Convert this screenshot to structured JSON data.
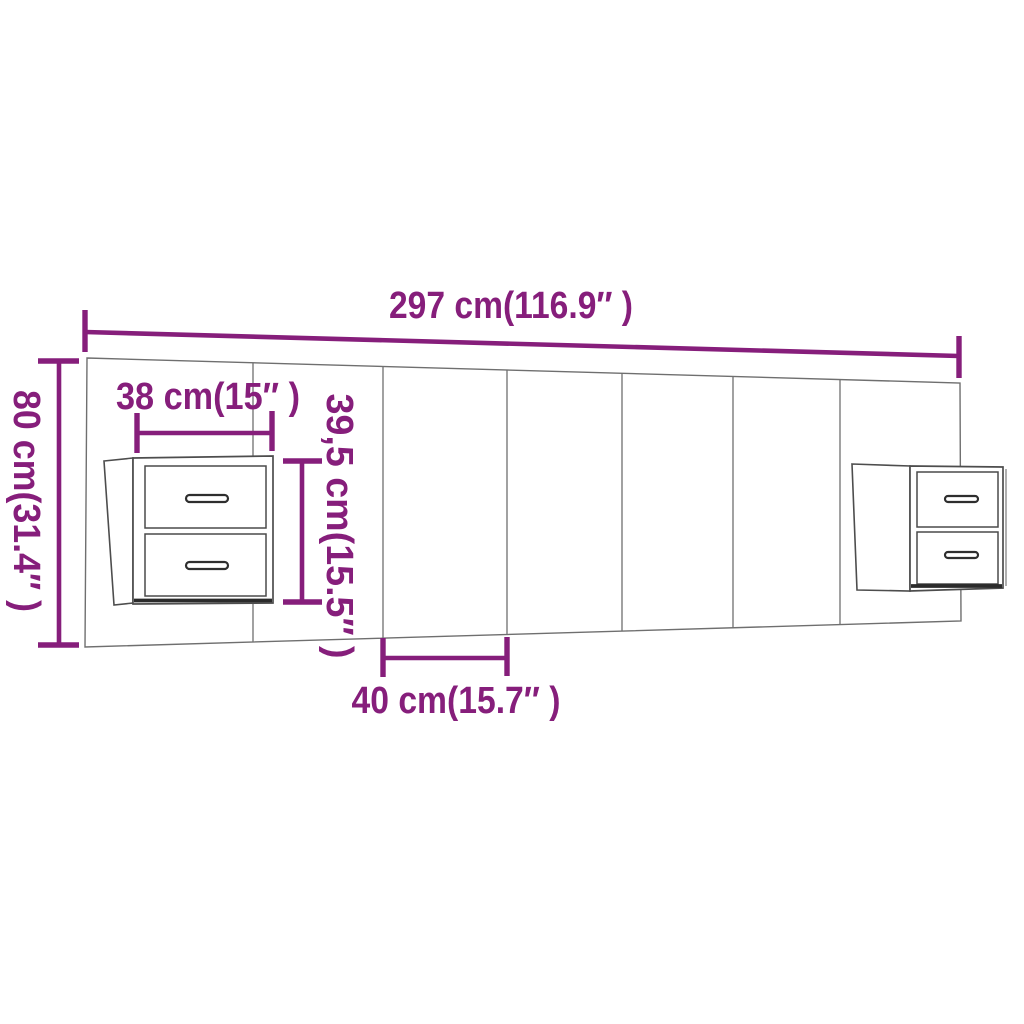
{
  "diagram": {
    "kind": "furniture dimension diagram",
    "subject": "wall headboard with two floating bedside cabinets (two drawers each)",
    "background_color": "#ffffff",
    "accent_color": "#861e7b",
    "outline_color": "#6f6f6f",
    "headboard": {
      "panel_seams": 6,
      "cabinet_count": 2,
      "drawers_per_cabinet": 2
    },
    "labels": {
      "total_width": "297 cm(116.9″ )",
      "total_height": "80 cm(31.4″ )",
      "cabinet_width": "38 cm(15″ )",
      "cabinet_height": "39,5 cm(15.5″ )",
      "panel_width": "40 cm(15.7″ )"
    }
  }
}
